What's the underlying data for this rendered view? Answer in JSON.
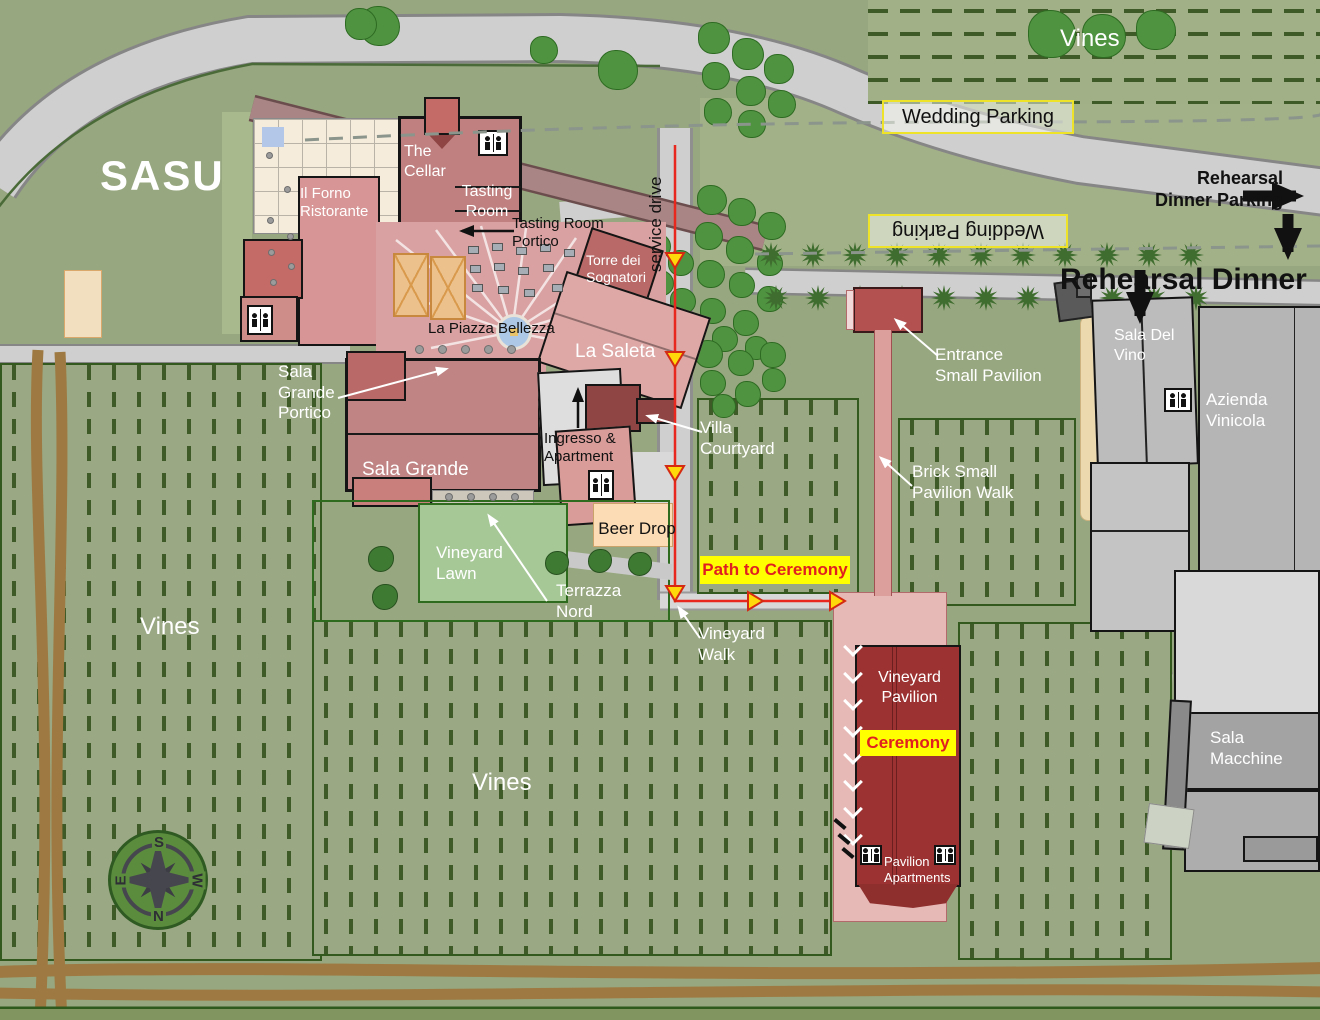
{
  "labels": {
    "sasu": "SASU",
    "vines_top": "Vines",
    "vines_left": "Vines",
    "vines_bottom": "Vines",
    "service_drive": "service drive",
    "wedding_parking": "Wedding Parking",
    "wedding_parking_2": "Wedding Parking",
    "rehearsal_line1": "Rehearsal",
    "rehearsal_line2": "Dinner Parking",
    "rehearsal_dinner": "Rehearsal Dinner",
    "the_cellar": "The Cellar",
    "tasting_room": "Tasting Room",
    "tasting_room_portico": "Tasting Room Portico",
    "il_forno": "Il Forno Ristorante",
    "torre": "Torre dei Sognatori",
    "piazza": "La Piazza Bellezza",
    "la_saleta": "La Saleta",
    "sala_grande": "Sala Grande",
    "sala_grande_portico": "Sala Grande Portico",
    "ingresso": "Ingresso & Apartment",
    "villa_courtyard": "Villa Courtyard",
    "beer_drop": "Beer Drop",
    "vineyard_lawn": "Vineyard Lawn",
    "terrazza_nord": "Terrazza Nord",
    "vineyard_walk": "Vineyard Walk",
    "path_to_ceremony": "Path to Ceremony",
    "entrance_small_pavilion": "Entrance Small Pavilion",
    "brick_walk": "Brick Small Pavilion Walk",
    "vineyard_pavilion": "Vineyard Pavilion",
    "ceremony": "Ceremony",
    "pavilion_apartments": "Pavilion Apartments",
    "sala_del_vino": "Sala Del Vino",
    "azienda_vinicola": "Azienda Vinicola",
    "sala_macchine": "Sala Macchine"
  },
  "compass": {
    "top": "S",
    "bottom": "N",
    "left": "E",
    "right": "W"
  },
  "colors": {
    "map_green": "#97a77f",
    "vine_dash_green": "#3e5a26",
    "road_gray": "#cfcfcf",
    "dirt_brown": "#9e7a42",
    "building_pink": "#d99c99",
    "roof_red": "#b96a68",
    "pavilion_dark_red": "#9c3332",
    "industrial_gray": "#b5b5b5",
    "highlight_yellow": "#ffff00",
    "route_red": "#e02020",
    "parking_box_yellow": "#efe32a",
    "tree_green": "#4f9341",
    "spiky_tree_green": "#3f6d2f"
  },
  "icons": {
    "restroom": "restroom-icon",
    "tree": "tree-icon",
    "compass": "compass-rose-icon",
    "fountain": "fountain-icon"
  }
}
